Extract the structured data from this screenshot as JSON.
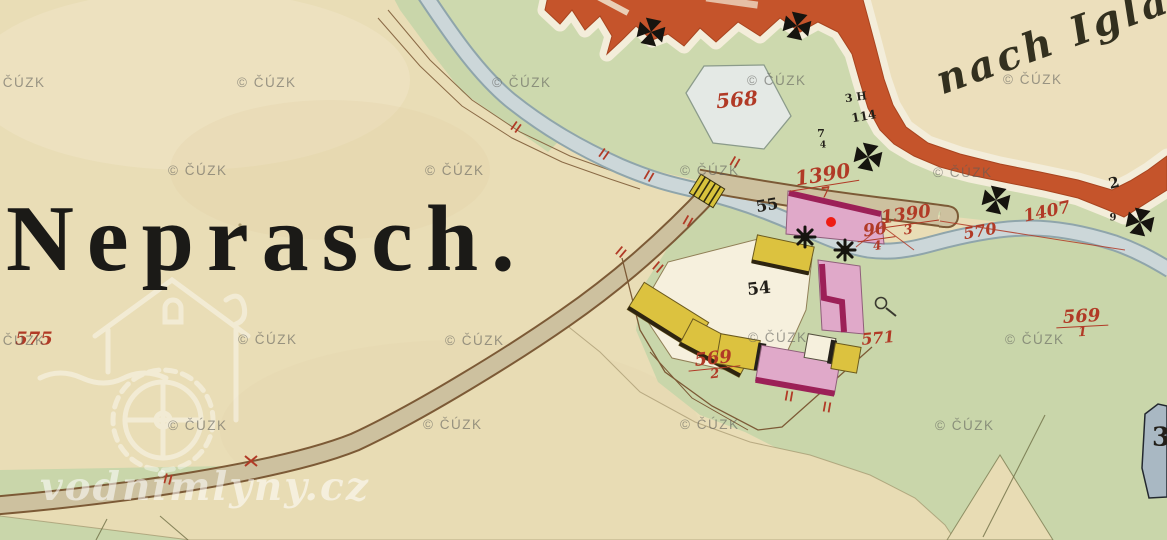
{
  "map_title": {
    "village_name": "Neprasch."
  },
  "route_label": {
    "text": "nach Iglau"
  },
  "watermark": {
    "copyright_text": "© ČÚZK",
    "brand_text": "vodnimlyny.cz",
    "positions": [
      {
        "x": -14,
        "y": 75
      },
      {
        "x": 237,
        "y": 75
      },
      {
        "x": 492,
        "y": 75
      },
      {
        "x": 747,
        "y": 73
      },
      {
        "x": 1003,
        "y": 72
      },
      {
        "x": 168,
        "y": 163
      },
      {
        "x": 425,
        "y": 163
      },
      {
        "x": 680,
        "y": 163
      },
      {
        "x": 933,
        "y": 165
      },
      {
        "x": -14,
        "y": 333
      },
      {
        "x": 238,
        "y": 332
      },
      {
        "x": 445,
        "y": 333
      },
      {
        "x": 748,
        "y": 330
      },
      {
        "x": 1005,
        "y": 332
      },
      {
        "x": 168,
        "y": 418
      },
      {
        "x": 423,
        "y": 417
      },
      {
        "x": 680,
        "y": 417
      },
      {
        "x": 935,
        "y": 418
      }
    ]
  },
  "parcel_labels_red": [
    {
      "text": "568",
      "x": 737,
      "y": 100,
      "size": 20,
      "rot": -5
    },
    {
      "text": "1390",
      "denom": "7",
      "x": 824,
      "y": 183,
      "size": 20,
      "rot": -9
    },
    {
      "text": "1390",
      "denom": "3",
      "x": 907,
      "y": 222,
      "size": 18,
      "rot": -8
    },
    {
      "text": "90",
      "denom": "4",
      "x": 876,
      "y": 237,
      "size": 17,
      "rot": -8
    },
    {
      "text": "570",
      "x": 980,
      "y": 231,
      "size": 16,
      "rot": -10
    },
    {
      "text": "1407",
      "x": 1047,
      "y": 212,
      "size": 17,
      "rot": -12
    },
    {
      "text": "571",
      "x": 878,
      "y": 338,
      "size": 16,
      "rot": -5
    },
    {
      "text": "569",
      "denom": "2",
      "x": 714,
      "y": 366,
      "size": 18,
      "rot": -6
    },
    {
      "text": "569",
      "denom": "1",
      "x": 1082,
      "y": 324,
      "size": 18,
      "rot": -3
    },
    {
      "text": "575",
      "x": 34,
      "y": 339,
      "size": 18,
      "rot": 0
    }
  ],
  "labels_black": [
    {
      "text": "55",
      "x": 767,
      "y": 205,
      "size": 16,
      "rot": -10
    },
    {
      "text": "54",
      "x": 759,
      "y": 289,
      "size": 17,
      "rot": -6
    },
    {
      "text": "2",
      "x": 1114,
      "y": 183,
      "size": 15,
      "rot": -15
    },
    {
      "text": "9",
      "x": 1113,
      "y": 218,
      "size": 10,
      "rot": 0
    },
    {
      "text": "3 H",
      "x": 856,
      "y": 98,
      "size": 11,
      "rot": -8
    },
    {
      "text": "114",
      "x": 864,
      "y": 117,
      "size": 12,
      "rot": -10
    },
    {
      "text": "7",
      "x": 821,
      "y": 134,
      "size": 11,
      "rot": 0
    },
    {
      "text": "4",
      "x": 823,
      "y": 146,
      "size": 9,
      "rot": 0
    },
    {
      "text": "3",
      "x": 1161,
      "y": 438,
      "size": 26,
      "rot": 0
    }
  ],
  "symbols": {
    "boundary_crosses": [
      {
        "x": 651,
        "y": 32
      },
      {
        "x": 797,
        "y": 26
      },
      {
        "x": 868,
        "y": 157
      },
      {
        "x": 996,
        "y": 200
      },
      {
        "x": 1140,
        "y": 222
      }
    ],
    "mill_wheels": [
      {
        "x": 805,
        "y": 237
      },
      {
        "x": 845,
        "y": 250
      }
    ],
    "red_ticks": [
      {
        "x": 516,
        "y": 127,
        "rot": 35
      },
      {
        "x": 604,
        "y": 154,
        "rot": 35
      },
      {
        "x": 649,
        "y": 176,
        "rot": 30
      },
      {
        "x": 688,
        "y": 221,
        "rot": 30
      },
      {
        "x": 621,
        "y": 252,
        "rot": 40
      },
      {
        "x": 658,
        "y": 267,
        "rot": 40
      },
      {
        "x": 735,
        "y": 162,
        "rot": 30
      },
      {
        "x": 789,
        "y": 396,
        "rot": 10
      },
      {
        "x": 827,
        "y": 407,
        "rot": 10
      },
      {
        "x": 168,
        "y": 479,
        "rot": 15
      }
    ],
    "red_x_mark": {
      "x": 251,
      "y": 461
    },
    "marker_dot": {
      "x": 831,
      "y": 222
    }
  },
  "colors": {
    "paper": "#e9ddb6",
    "paper_light": "#f1e7c9",
    "meadow_green": "#cdd9ae",
    "meadow_green_dark": "#c3d2a2",
    "road_red": "#c5542b",
    "road_halo": "#f3edda",
    "stream_fill": "#ccd7d9",
    "stream_edge": "#8fa5ab",
    "road_tan": "#cdc19f",
    "road_edge": "#7c5a36",
    "building_yellow": "#dcc23f",
    "building_pink": "#e0a9c9",
    "building_magenta": "#9c2057",
    "building_white": "#f6f0dd",
    "building_slate": "#a9b8c3",
    "parcel_568_fill": "#e4e9e5",
    "label_red": "#b13a26",
    "label_black": "#221f19",
    "watermark_gray": "#5c5c58",
    "brand_white": "#ffffff",
    "marker_red": "#ee1c13"
  }
}
